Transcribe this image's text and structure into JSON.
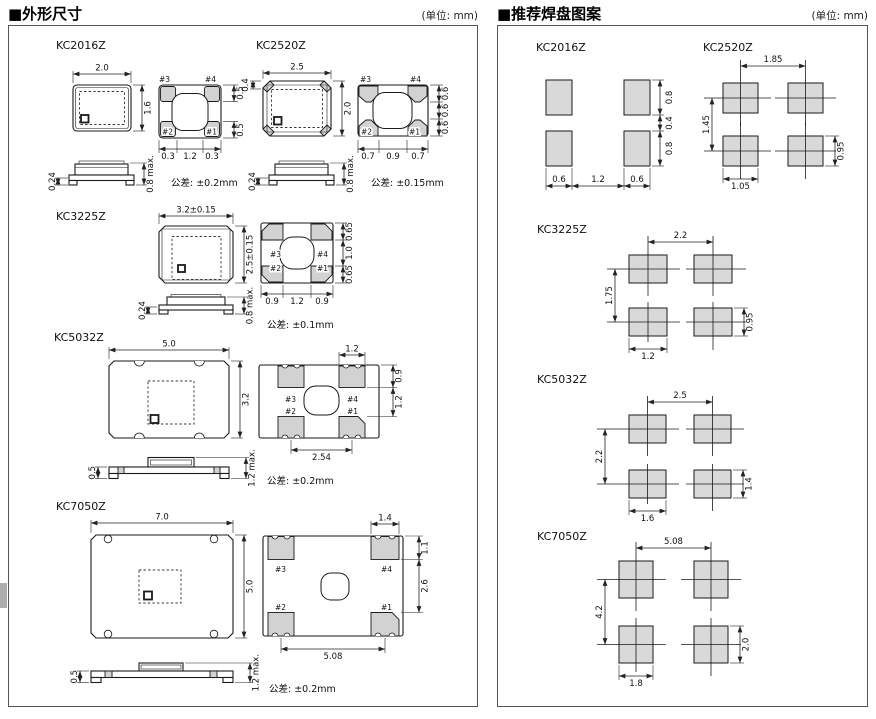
{
  "headers": {
    "left_title": "■外形尺寸",
    "right_title": "■推荐焊盘图案",
    "unit": "(单位: mm)"
  },
  "pads": {
    "p1": "#1",
    "p2": "#2",
    "p3": "#3",
    "p4": "#4"
  },
  "outline": {
    "kc2016z": {
      "title": "KC2016Z",
      "top_w": "2.0",
      "top_h": "1.6",
      "r1": "0.5",
      "r2": "0.5",
      "b1": "0.3",
      "b2": "1.2",
      "b3": "0.3",
      "s1": "0.24",
      "s2": "0.8 max.",
      "tol": "公差: ±0.2mm"
    },
    "kc2520z": {
      "title": "KC2520Z",
      "top_w": "2.5",
      "top_h": "2.0",
      "corner": "0.4",
      "r1": "0.6",
      "r2": "0.6",
      "r3": "0.6",
      "b1": "0.7",
      "b2": "0.9",
      "b3": "0.7",
      "s1": "0.24",
      "s2": "0.8 max.",
      "tol": "公差: ±0.15mm"
    },
    "kc3225z": {
      "title": "KC3225Z",
      "top_w": "3.2±0.15",
      "top_h": "2.5±0.15",
      "r1": "0.65",
      "r2": "1.0",
      "r3": "0.65",
      "b1": "0.9",
      "b2": "1.2",
      "b3": "0.9",
      "s1": "0.24",
      "s2": "0.8 max.",
      "tol": "公差: ±0.1mm"
    },
    "kc5032z": {
      "title": "KC5032Z",
      "top_w": "5.0",
      "top_h": "3.2",
      "pad_w": "1.2",
      "r1": "0.9",
      "r2": "1.2",
      "b": "2.54",
      "s1": "0.5",
      "s2": "1.2 max.",
      "tol": "公差: ±0.2mm"
    },
    "kc7050z": {
      "title": "KC7050Z",
      "top_w": "7.0",
      "top_h": "5.0",
      "pad_w": "1.4",
      "r1": "1.1",
      "r2": "2.6",
      "b": "5.08",
      "s1": "0.5",
      "s2": "1.2 max.",
      "tol": "公差: ±0.2mm"
    }
  },
  "land": {
    "kc2016z": {
      "title": "KC2016Z",
      "r1": "0.8",
      "r2": "0.4",
      "r3": "0.8",
      "b1": "0.6",
      "b2": "1.2",
      "b3": "0.6"
    },
    "kc2520z": {
      "title": "KC2520Z",
      "top": "1.85",
      "left": "1.45",
      "bottom": "1.05",
      "right": "0.95"
    },
    "kc3225z": {
      "title": "KC3225Z",
      "top": "2.2",
      "left": "1.75",
      "bottom": "1.2",
      "right": "0.95"
    },
    "kc5032z": {
      "title": "KC5032Z",
      "top": "2.5",
      "left": "2.2",
      "bottom": "1.6",
      "right": "1.4"
    },
    "kc7050z": {
      "title": "KC7050Z",
      "top": "5.08",
      "left": "4.2",
      "bottom": "1.8",
      "right": "2.0"
    }
  }
}
